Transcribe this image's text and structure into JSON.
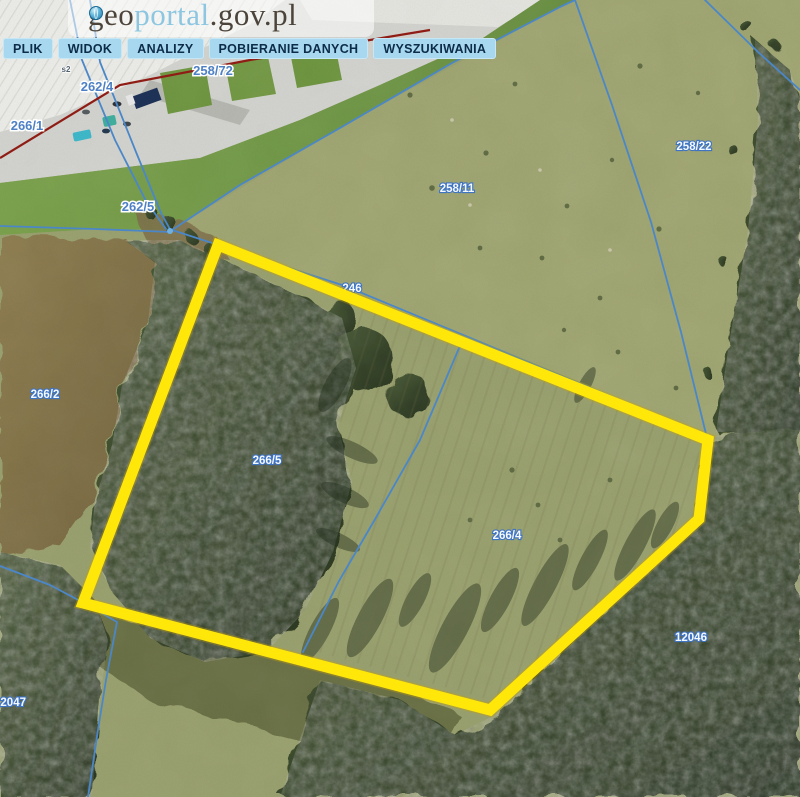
{
  "logo": {
    "part1": "geo",
    "part2": "portal",
    "part3": ".gov.pl"
  },
  "menu": {
    "items": [
      {
        "label": "PLIK"
      },
      {
        "label": "WIDOK"
      },
      {
        "label": "ANALIZY"
      },
      {
        "label": "POBIERANIE DANYCH"
      },
      {
        "label": "WYSZUKIWANIA"
      }
    ]
  },
  "map": {
    "labels": [
      {
        "text": "s2"
      },
      {
        "text": "258/72"
      },
      {
        "text": "262/4"
      },
      {
        "text": "266/1"
      },
      {
        "text": "262/5"
      },
      {
        "text": "258/11"
      },
      {
        "text": "258/22"
      },
      {
        "text": "266/2"
      },
      {
        "text": "246"
      },
      {
        "text": "266/5"
      },
      {
        "text": "266/4"
      },
      {
        "text": "12046"
      },
      {
        "text": "12047"
      }
    ],
    "colors": {
      "highlight": "#ffe70a",
      "parcel_boundary": "#4b87c8",
      "road": "#8f1d15"
    }
  }
}
